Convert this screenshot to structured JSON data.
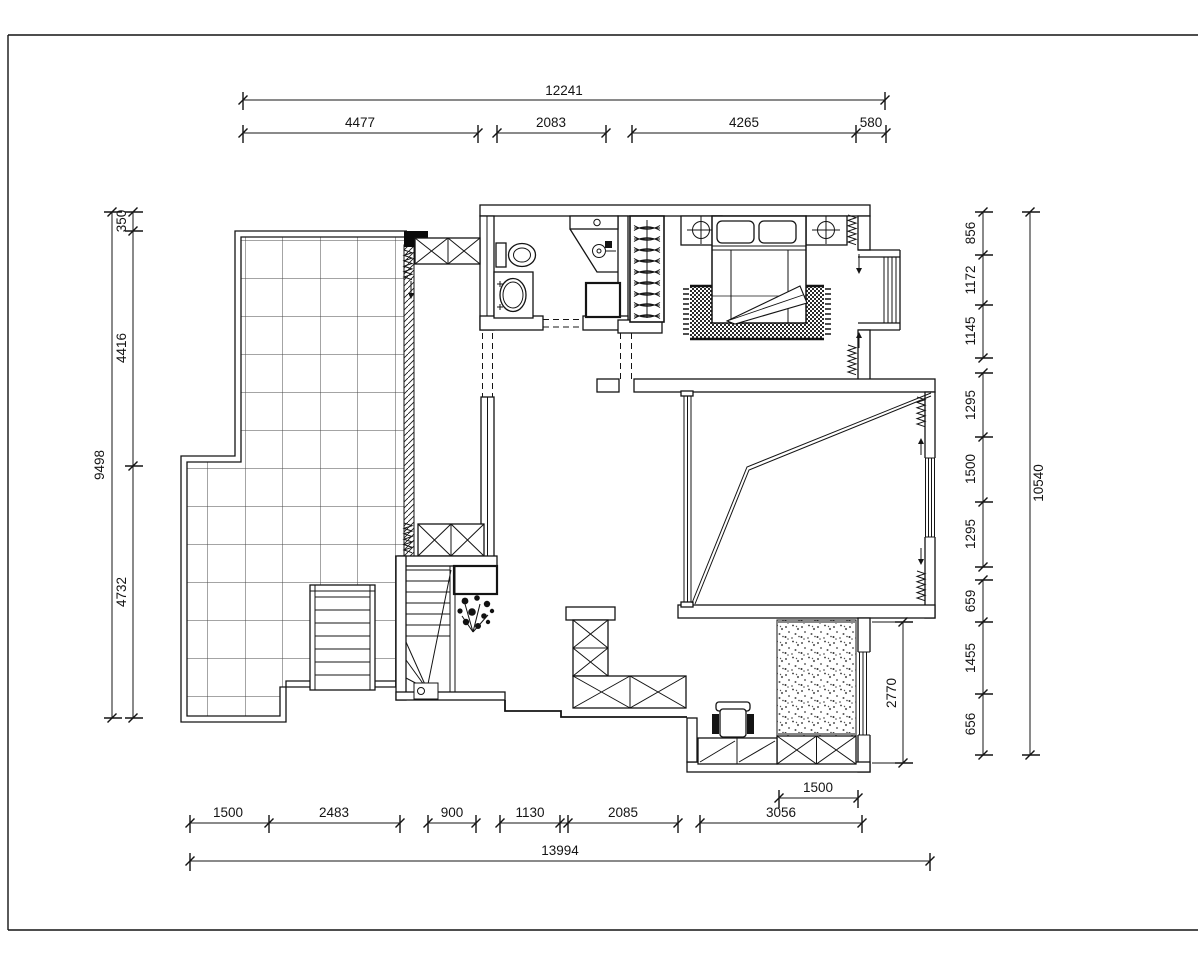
{
  "drawing": {
    "type": "architectural floor plan",
    "background_color": "#ffffff",
    "line_color": "#141414",
    "tile_grid_color": "#4a4a4a",
    "dims": {
      "top": {
        "total": "12241",
        "segments": [
          "4477",
          "2083",
          "4265",
          "580"
        ]
      },
      "left": {
        "total": "9498",
        "segments": [
          "350",
          "4416",
          "4732"
        ]
      },
      "right": {
        "total": "10540",
        "segments": [
          "856",
          "1172",
          "1145",
          "1295",
          "1500",
          "1295",
          "659",
          "1455",
          "656"
        ]
      },
      "bottom": {
        "total": "13994",
        "segments": [
          "1500",
          "2483",
          "900",
          "1130",
          "2085",
          "3056"
        ],
        "inner": "1500"
      },
      "interior": {
        "study_depth": "2770"
      }
    }
  }
}
